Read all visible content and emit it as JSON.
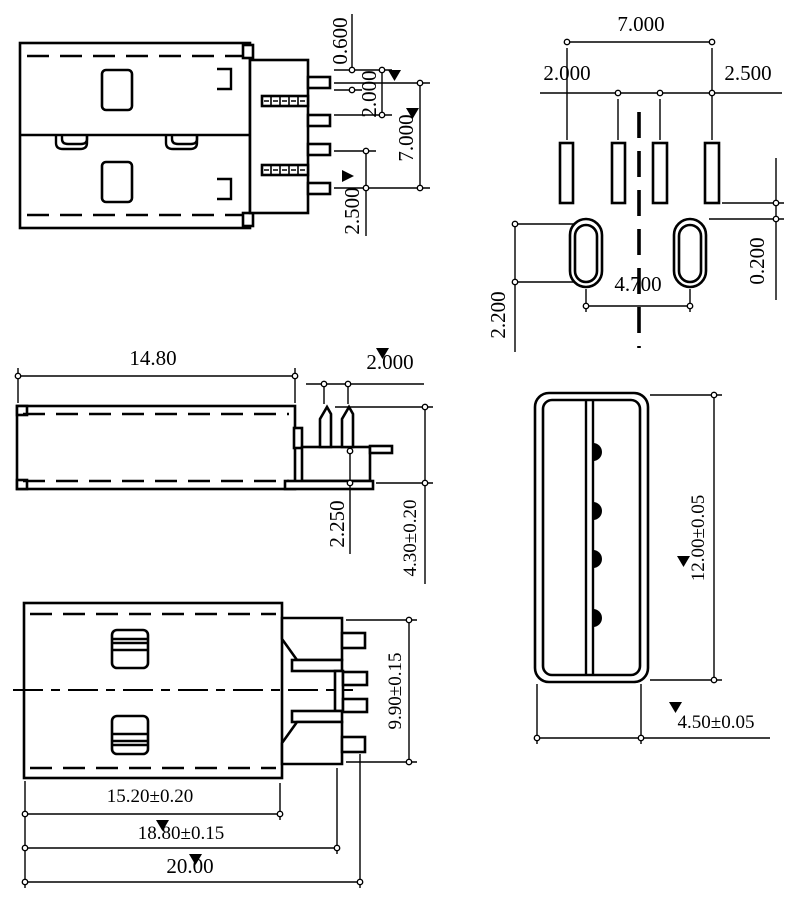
{
  "drawing": {
    "title": "USB Type-A plug dimensional drawing",
    "line_color": "#000000",
    "background": "#ffffff",
    "views": {
      "side": {
        "name": "plug side view with solder pins",
        "dims": {
          "pin_thickness": "0.600",
          "pitch_a": "2.000",
          "span": "7.000",
          "pitch_b": "2.500"
        }
      },
      "footprint": {
        "name": "PCB footprint view",
        "dims": {
          "span": "7.000",
          "pitch_inner": "2.000",
          "pitch_outer": "2.500",
          "clearance": "0.200",
          "hole_pitch": "4.700",
          "hole_len": "2.200"
        }
      },
      "profile": {
        "name": "side profile view",
        "dims": {
          "length": "14.80",
          "hook_pitch": "2.000",
          "pin_drop": "2.250",
          "height": "4.30±0.20"
        }
      },
      "top": {
        "name": "top view",
        "dims": {
          "pin_span": "9.90±0.15",
          "shell_len": "15.20±0.20",
          "body_len": "18.80±0.15",
          "total_len": "20.00"
        }
      },
      "front": {
        "name": "front mating-face view",
        "dims": {
          "width": "12.00±0.05",
          "height": "4.50±0.05"
        }
      }
    }
  }
}
